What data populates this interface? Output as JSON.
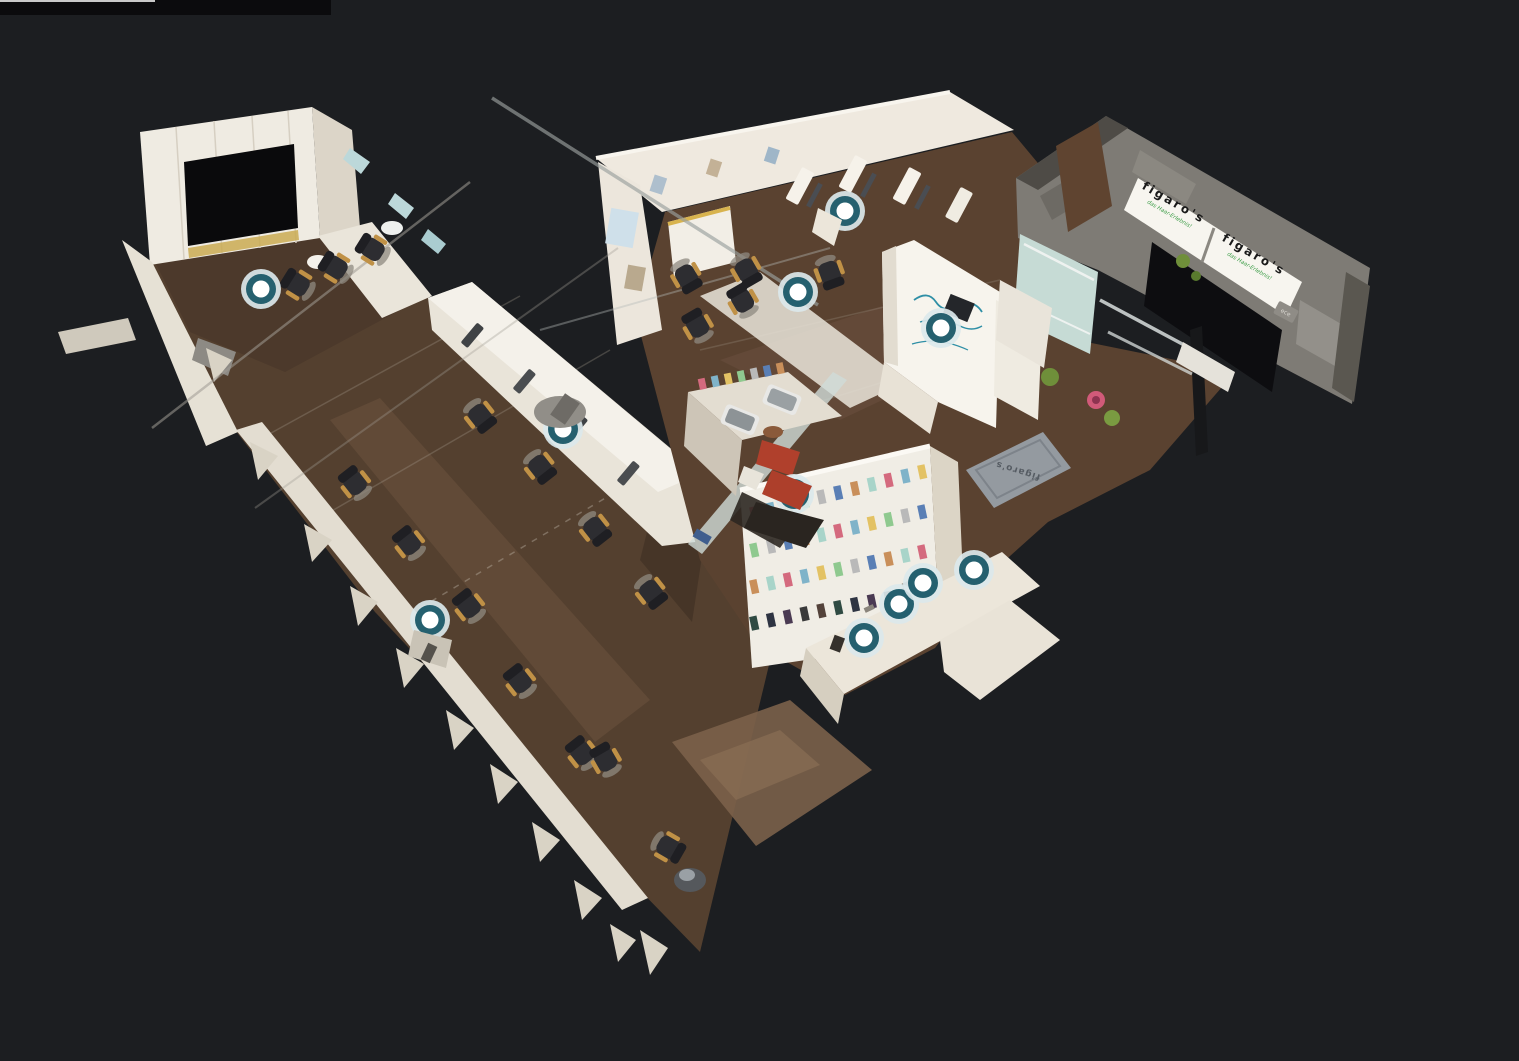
{
  "viewer": {
    "background_color": "#1c1e21",
    "artifact_bar_color": "#0b0b0d",
    "artifact_line_color": "#c9c9c9"
  },
  "scene": {
    "view_mode": "dollhouse-3d",
    "signage": {
      "sign1": {
        "brand": "figaro's",
        "tagline": "das Haar-Erlebnis!"
      },
      "sign2": {
        "brand": "figaro's",
        "tagline": "das Haar-Erlebnis!"
      }
    },
    "doormat": {
      "text": "figaro's"
    },
    "socket": {
      "text": "ece"
    },
    "marker_style": {
      "center": "#ffffff",
      "ring": "#25606f",
      "halo": "#dbe8ec"
    },
    "nav_markers": [
      {
        "id": "marker-1",
        "x": 261,
        "y": 289
      },
      {
        "id": "marker-2",
        "x": 845,
        "y": 211
      },
      {
        "id": "marker-3",
        "x": 798,
        "y": 292
      },
      {
        "id": "marker-4",
        "x": 941,
        "y": 328
      },
      {
        "id": "marker-5",
        "x": 563,
        "y": 429
      },
      {
        "id": "marker-6",
        "x": 794,
        "y": 494
      },
      {
        "id": "marker-7",
        "x": 430,
        "y": 620
      },
      {
        "id": "marker-8",
        "x": 864,
        "y": 638
      },
      {
        "id": "marker-9",
        "x": 899,
        "y": 604
      },
      {
        "id": "marker-10",
        "x": 923,
        "y": 583
      },
      {
        "id": "marker-11",
        "x": 974,
        "y": 570
      }
    ]
  }
}
